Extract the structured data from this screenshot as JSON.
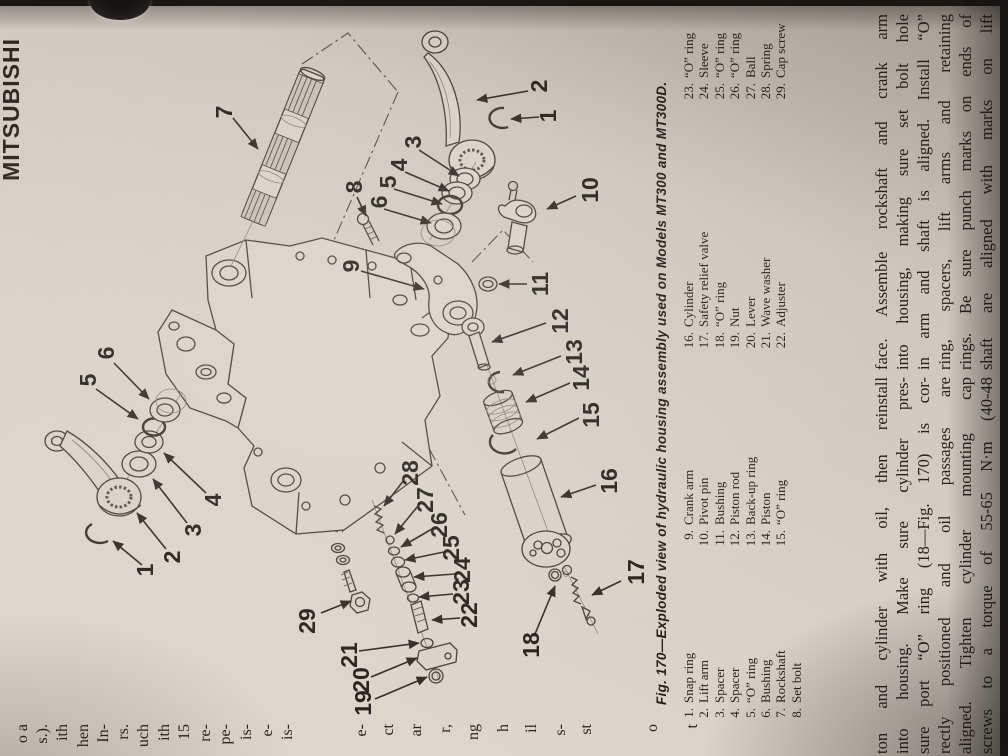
{
  "photo": {
    "background": "#221e1b",
    "paper": "#d7d2c8"
  },
  "page": {
    "brand": "MITSUBISHI",
    "left_edge_fragments": [
      {
        "t": "o a",
        "y": 34
      },
      {
        "t": "s.).",
        "y": 54
      },
      {
        "t": "ith",
        "y": 74
      },
      {
        "t": "hen",
        "y": 95
      },
      {
        "t": "In-",
        "y": 115
      },
      {
        "t": "rs.",
        "y": 135
      },
      {
        "t": "uch",
        "y": 155
      },
      {
        "t": "ith",
        "y": 176
      },
      {
        "t": "15",
        "y": 196
      },
      {
        "t": "re-",
        "y": 217
      },
      {
        "t": "pe-",
        "y": 237
      },
      {
        "t": "is-",
        "y": 258
      },
      {
        "t": "e-",
        "y": 279
      },
      {
        "t": "is-",
        "y": 299
      },
      {
        "t": "e-",
        "y": 373
      },
      {
        "t": "ct",
        "y": 400
      },
      {
        "t": "ar",
        "y": 428
      },
      {
        "t": "r,",
        "y": 457
      },
      {
        "t": "ng",
        "y": 485
      },
      {
        "t": "h",
        "y": 515
      },
      {
        "t": "il",
        "y": 543
      },
      {
        "t": "s-",
        "y": 572
      },
      {
        "t": "st",
        "y": 598
      },
      {
        "t": "o",
        "y": 664
      },
      {
        "t": "t",
        "y": 704
      }
    ],
    "figure": {
      "caption": "Fig. 170—Exploded view of hydraulic housing assembly used on Models MT300 and MT300D.",
      "legend": [
        {
          "items": [
            {
              "n": "1.",
              "t": "Snap ring"
            },
            {
              "n": "2.",
              "t": "Lift arm"
            },
            {
              "n": "3.",
              "t": "Spacer"
            },
            {
              "n": "4.",
              "t": "Spacer"
            },
            {
              "n": "5.",
              "t": "“O” ring"
            },
            {
              "n": "6.",
              "t": "Bushing"
            },
            {
              "n": "7.",
              "t": "Rockshaft"
            },
            {
              "n": "8.",
              "t": "Set bolt"
            }
          ]
        },
        {
          "items": [
            {
              "n": "9.",
              "t": "Crank arm"
            },
            {
              "n": "10.",
              "t": "Pivot pin"
            },
            {
              "n": "11.",
              "t": "Bushing"
            },
            {
              "n": "12.",
              "t": "Piston rod"
            },
            {
              "n": "13.",
              "t": "Back-up ring"
            },
            {
              "n": "14.",
              "t": "Piston"
            },
            {
              "n": "15.",
              "t": "“O” ring"
            }
          ]
        },
        {
          "items": [
            {
              "n": "16.",
              "t": "Cylinder"
            },
            {
              "n": "17.",
              "t": "Safety relief valve"
            },
            {
              "n": "18.",
              "t": "“O” ring"
            },
            {
              "n": "19.",
              "t": "Nut"
            },
            {
              "n": "20.",
              "t": "Lever"
            },
            {
              "n": "21.",
              "t": "Wave washer"
            },
            {
              "n": "22.",
              "t": "Adjuster"
            }
          ]
        },
        {
          "items": [
            {
              "n": "23.",
              "t": "“O” ring"
            },
            {
              "n": "24.",
              "t": "Sleeve"
            },
            {
              "n": "25.",
              "t": "“O” ring"
            },
            {
              "n": "26.",
              "t": "“O” ring"
            },
            {
              "n": "27.",
              "t": "Ball"
            },
            {
              "n": "28.",
              "t": "Spring"
            },
            {
              "n": "29.",
              "t": "Cap screw"
            }
          ]
        }
      ],
      "callouts": [
        {
          "n": "7",
          "x": 224,
          "y": 112
        },
        {
          "n": "8",
          "x": 354,
          "y": 187
        },
        {
          "n": "3",
          "x": 413,
          "y": 142
        },
        {
          "n": "4",
          "x": 399,
          "y": 165
        },
        {
          "n": "5",
          "x": 388,
          "y": 182
        },
        {
          "n": "6",
          "x": 379,
          "y": 202
        },
        {
          "n": "2",
          "x": 539,
          "y": 86
        },
        {
          "n": "1",
          "x": 548,
          "y": 116
        },
        {
          "n": "10",
          "x": 590,
          "y": 190
        },
        {
          "n": "9",
          "x": 351,
          "y": 266
        },
        {
          "n": "11",
          "x": 540,
          "y": 284
        },
        {
          "n": "12",
          "x": 560,
          "y": 321
        },
        {
          "n": "13",
          "x": 574,
          "y": 352
        },
        {
          "n": "14",
          "x": 581,
          "y": 378
        },
        {
          "n": "15",
          "x": 591,
          "y": 415
        },
        {
          "n": "16",
          "x": 609,
          "y": 481
        },
        {
          "n": "17",
          "x": 636,
          "y": 572
        },
        {
          "n": "18",
          "x": 531,
          "y": 645
        },
        {
          "n": "19",
          "x": 363,
          "y": 703
        },
        {
          "n": "20",
          "x": 361,
          "y": 680
        },
        {
          "n": "21",
          "x": 349,
          "y": 655
        },
        {
          "n": "22",
          "x": 469,
          "y": 615
        },
        {
          "n": "23",
          "x": 461,
          "y": 592
        },
        {
          "n": "24",
          "x": 462,
          "y": 570
        },
        {
          "n": "25",
          "x": 451,
          "y": 548
        },
        {
          "n": "26",
          "x": 439,
          "y": 525
        },
        {
          "n": "27",
          "x": 425,
          "y": 500
        },
        {
          "n": "28",
          "x": 410,
          "y": 473
        },
        {
          "n": "29",
          "x": 307,
          "y": 621
        },
        {
          "n": "1",
          "x": 145,
          "y": 570
        },
        {
          "n": "2",
          "x": 172,
          "y": 557
        },
        {
          "n": "3",
          "x": 193,
          "y": 530
        },
        {
          "n": "4",
          "x": 213,
          "y": 500
        },
        {
          "n": "5",
          "x": 88,
          "y": 380
        },
        {
          "n": "6",
          "x": 106,
          "y": 353
        }
      ]
    },
    "body_left": [
      "ton and cylinder with oil, then reinstall",
      "into housing. Make sure cylinder pres-",
      "sure port “O” ring (18—Fig. 170) is cor-",
      "rectly positioned and oil passages are",
      "aligned. Tighten cylinder mounting cap",
      "screws to a torque of 55-65 N·m (40-48"
    ],
    "body_right": [
      "face. Assemble rockshaft and crank arm",
      "into housing, making sure set bolt hole",
      "in arm and shaft is aligned. Install “O”",
      "ring, spacers, lift arms and retaining",
      "rings. Be sure punch marks on ends of",
      "shaft are aligned with marks on lift"
    ]
  }
}
